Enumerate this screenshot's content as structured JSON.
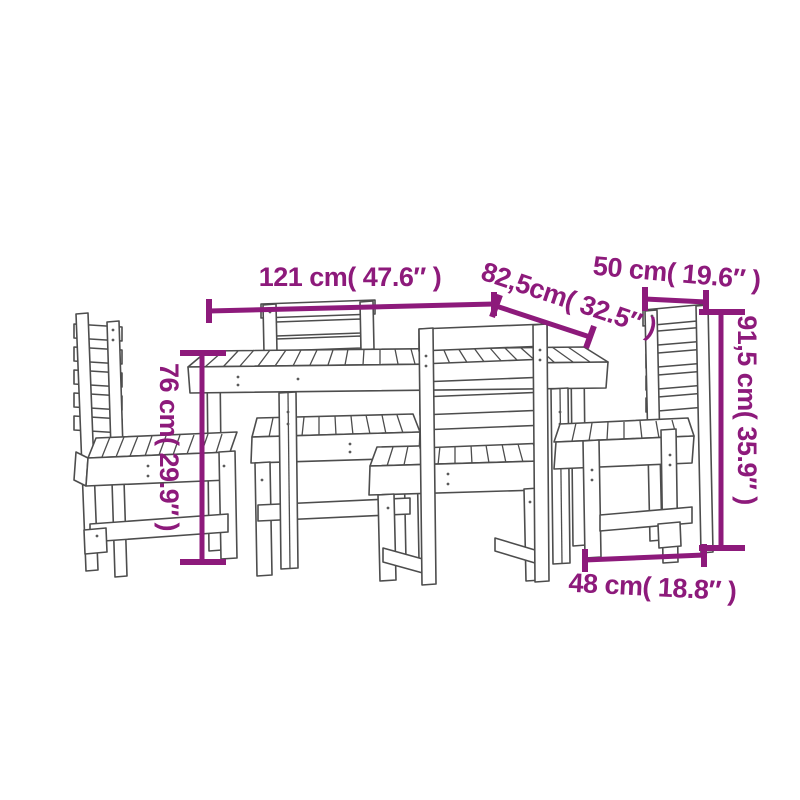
{
  "canvas": {
    "background": "#ffffff",
    "width": 800,
    "height": 800
  },
  "diagram": {
    "subject": "5-piece wooden dining set (table with slatted top and 4 ladder-back chairs) dimension drawing",
    "accent_color": "#8d1a7b",
    "outline_color": "#4d4d4d",
    "dimensions": {
      "table_width": {
        "label": "121 cm( 47.6″ )"
      },
      "table_depth": {
        "label": "82,5cm( 32.5″ )"
      },
      "chair_width": {
        "label": "50 cm( 19.6″ )"
      },
      "chair_height": {
        "label": "91,5 cm( 35.9″ )"
      },
      "table_height": {
        "label": "76 cm( 29.9″ )"
      },
      "chair_depth": {
        "label": "48 cm( 18.8″ )"
      }
    }
  }
}
